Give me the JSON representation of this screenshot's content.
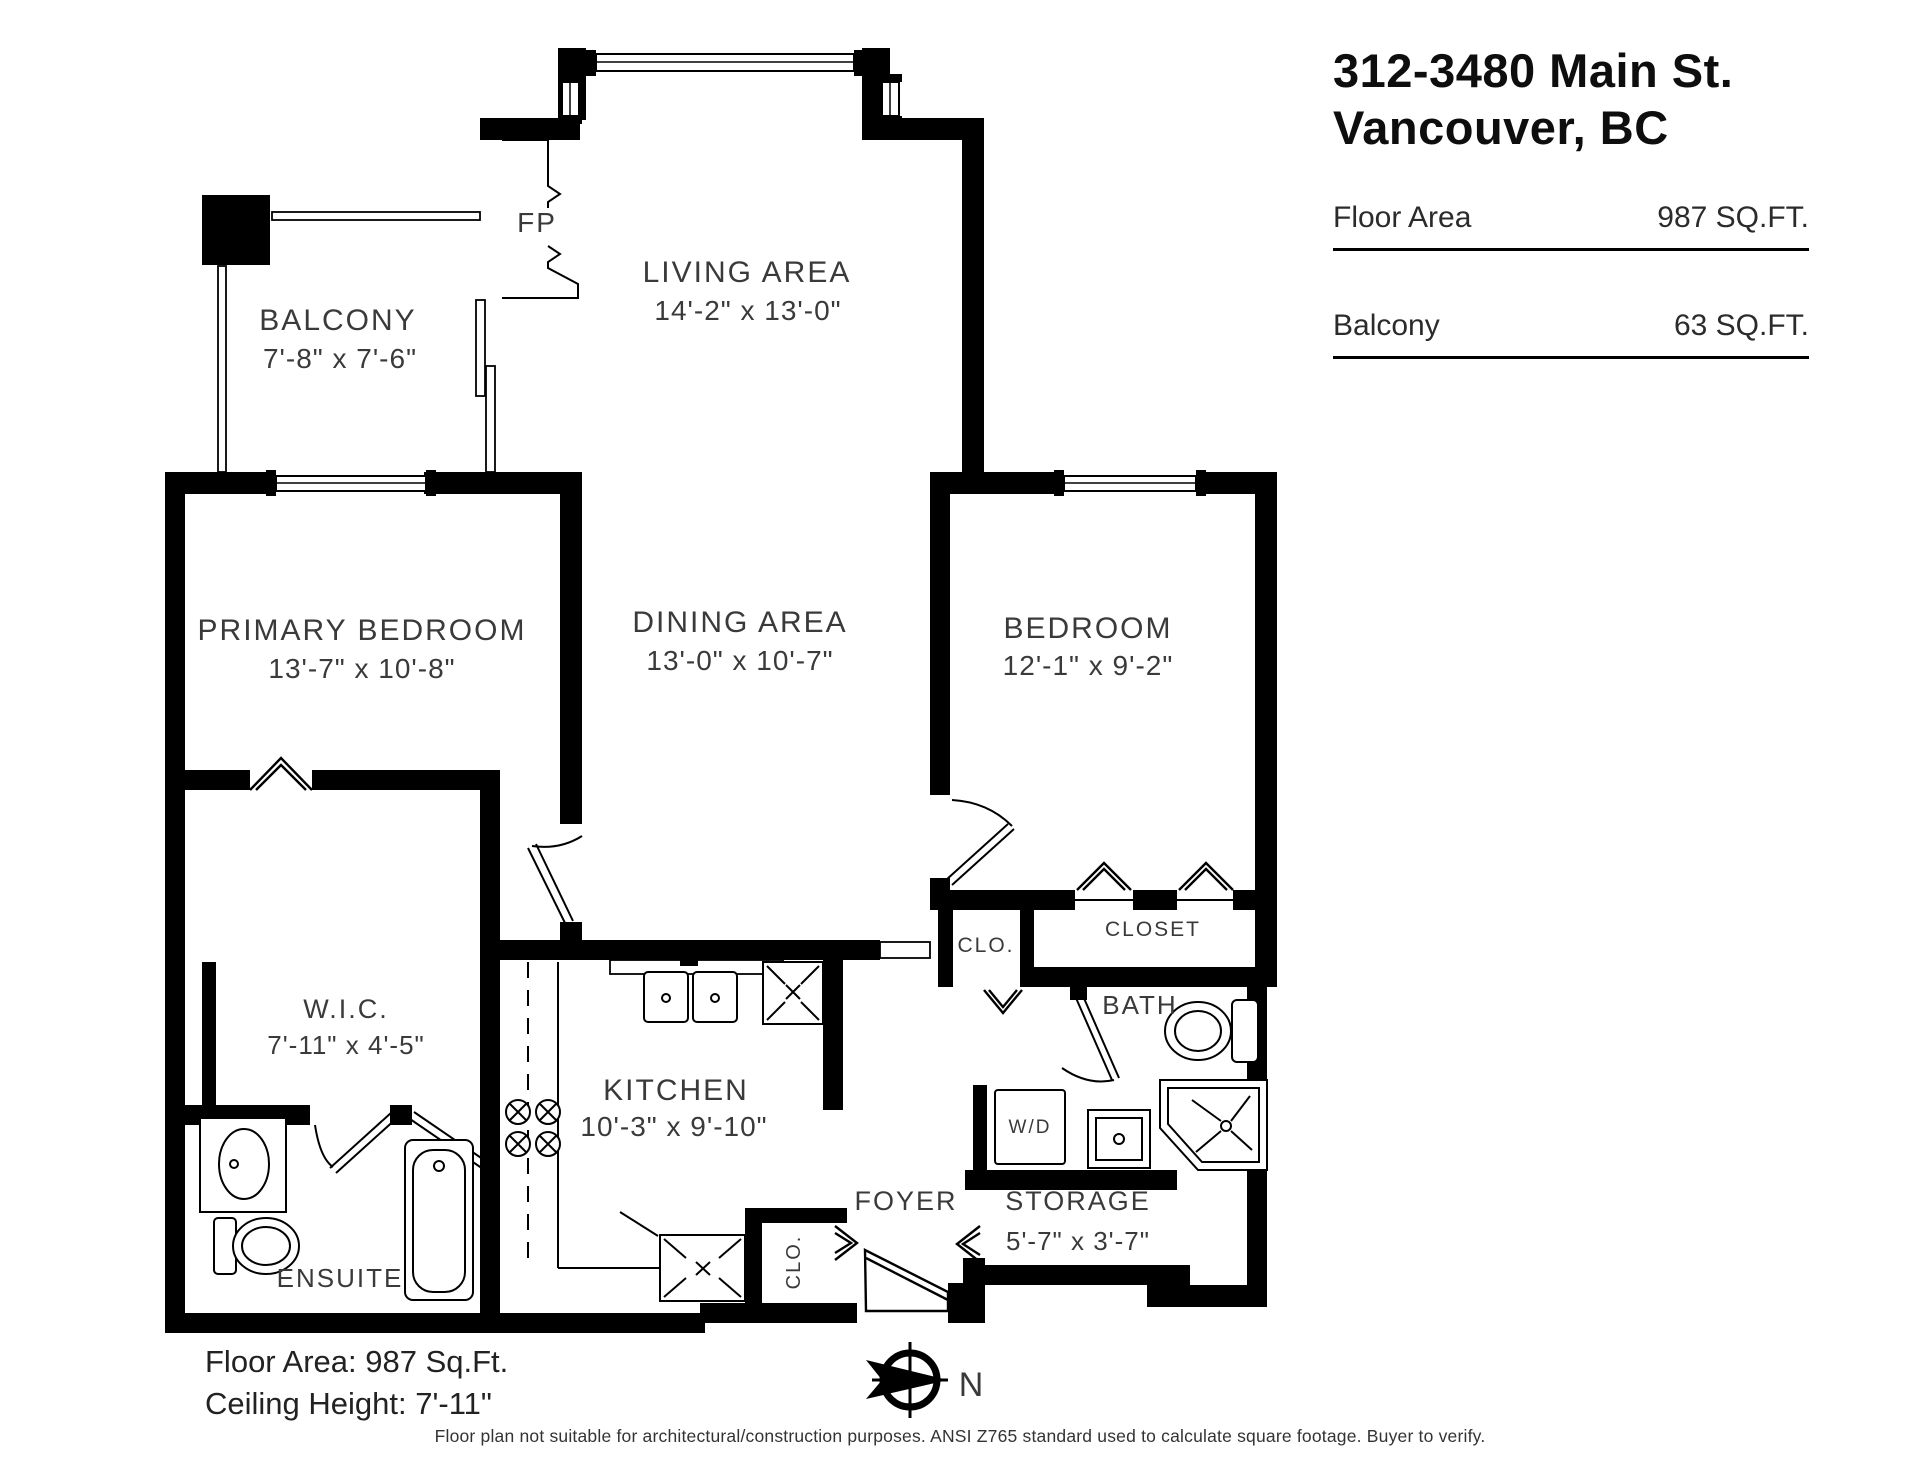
{
  "header": {
    "title_line1": "312-3480 Main St.",
    "title_line2": "Vancouver, BC",
    "stats": [
      {
        "label": "Floor Area",
        "value": "987 SQ.FT."
      },
      {
        "label": "Balcony",
        "value": "63 SQ.FT."
      }
    ]
  },
  "rooms": {
    "balcony": {
      "name": "BALCONY",
      "dims": "7'-8\" x 7'-6\""
    },
    "living": {
      "name": "LIVING AREA",
      "dims": "14'-2\" x 13'-0\""
    },
    "primary": {
      "name": "PRIMARY BEDROOM",
      "dims": "13'-7\" x 10'-8\""
    },
    "dining": {
      "name": "DINING AREA",
      "dims": "13'-0\" x 10'-7\""
    },
    "bedroom": {
      "name": "BEDROOM",
      "dims": "12'-1\" x 9'-2\""
    },
    "wic": {
      "name": "W.I.C.",
      "dims": "7'-11\" x 4'-5\""
    },
    "kitchen": {
      "name": "KITCHEN",
      "dims": "10'-3\" x 9'-10\""
    },
    "storage": {
      "name": "STORAGE",
      "dims": "5'-7\" x 3'-7\""
    }
  },
  "labels": {
    "fp": "FP",
    "clo_bedroom": "CLO.",
    "closet": "CLOSET",
    "bath": "BATH",
    "wd": "W/D",
    "ensuite": "ENSUITE",
    "foyer": "FOYER",
    "clo_foyer": "CLO.",
    "north": "N"
  },
  "notes": {
    "floor_area": "Floor Area: 987 Sq.Ft.",
    "ceiling_height": "Ceiling Height: 7'-11\"",
    "disclaimer": "Floor plan not suitable for architectural/construction purposes. ANSI Z765 standard used to calculate square footage. Buyer to verify."
  }
}
